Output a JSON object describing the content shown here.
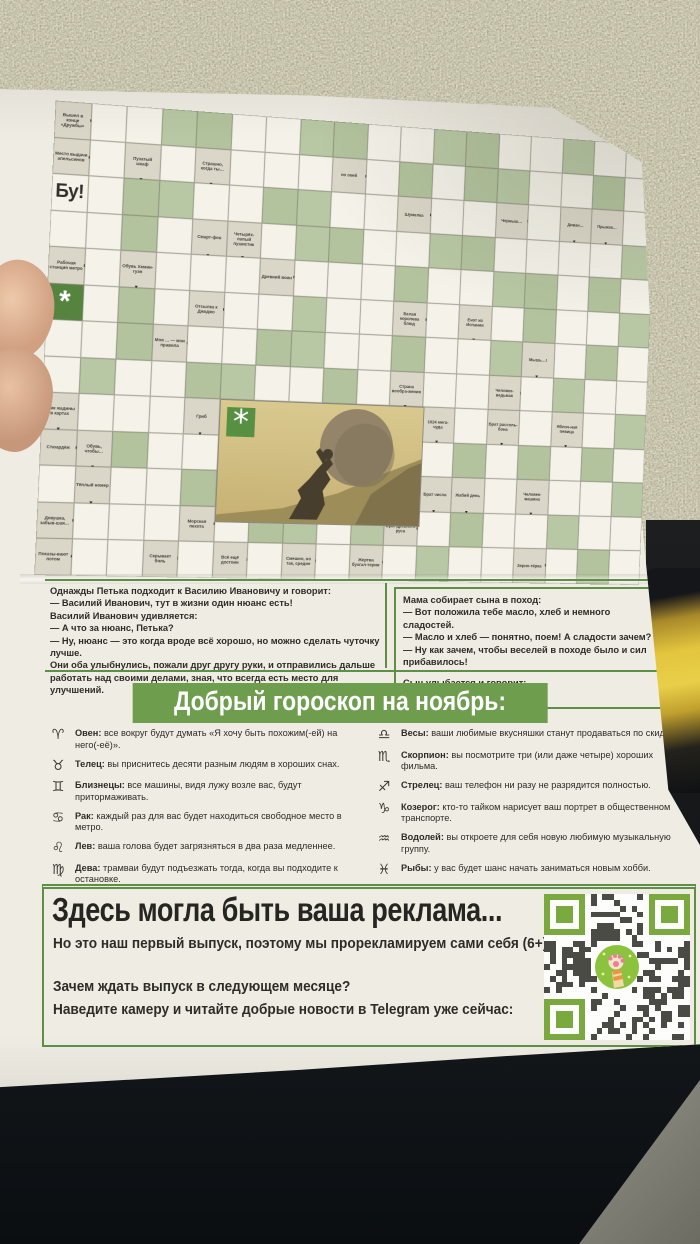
{
  "colors": {
    "accent_green": "#5d8f46",
    "heading_green": "#6f9d4e",
    "cell_green": "#b8c8a4",
    "clue_bg": "#dad7c8",
    "qr_green": "#79a93f",
    "paper": "#efece3"
  },
  "crossword": {
    "cols": 18,
    "bu": "Бу!",
    "asterisk": "*",
    "rows": [
      "cwwggwwggwwggwwgww",
      "cwcwcwwwcwgwggwwgw",
      "Bwggwwggwwcwwcwccw",
      "wwgwccwggwwggwwwwg",
      "cwcwwwcwwwgwwggwgw",
      "Awgwcwwgwwcwcwgwwg",
      "wwgcwwggwwgwwgcwgw",
      "wgwwggwwgwcwwcwgww",
      "cwwwciiiiiicwcwcwg",
      "ccgwwiiiiiiwgwgwgw",
      "wcwwgiiiiiiccwcwwg",
      "cwwwcwggwgcwgwwgww",
      "cwwcwcwcwcwgwwcwgw"
    ],
    "clues": [
      {
        "r": 0,
        "c": 0,
        "t": "Вышел в конце «Дружбы»",
        "a": "r"
      },
      {
        "r": 1,
        "c": 0,
        "t": "Место выдачи апельсинов",
        "a": "r"
      },
      {
        "r": 1,
        "c": 2,
        "t": "Пузатый шкаф",
        "a": "d"
      },
      {
        "r": 1,
        "c": 4,
        "t": "Страшно, когда ты…",
        "a": "d"
      },
      {
        "r": 1,
        "c": 8,
        "t": "но окей",
        "a": "r"
      },
      {
        "r": 2,
        "c": 10,
        "t": "Шумелка",
        "a": "r"
      },
      {
        "r": 2,
        "c": 13,
        "t": "Черныш…",
        "a": "r"
      },
      {
        "r": 2,
        "c": 15,
        "t": "Диван…",
        "a": "d"
      },
      {
        "r": 2,
        "c": 16,
        "t": "Прыжок…",
        "a": "d"
      },
      {
        "r": 3,
        "c": 4,
        "t": "Смарт-фон",
        "a": "d"
      },
      {
        "r": 3,
        "c": 5,
        "t": "Четырёх-лапый пушистик",
        "a": "d"
      },
      {
        "r": 4,
        "c": 0,
        "t": "Рабочая станция метро",
        "a": "r"
      },
      {
        "r": 4,
        "c": 2,
        "t": "Обувь Хемин-гуэя",
        "a": "d"
      },
      {
        "r": 4,
        "c": 6,
        "t": "Древний воин",
        "a": "r"
      },
      {
        "r": 5,
        "c": 4,
        "t": "Отсылка к Джоджо",
        "a": "r"
      },
      {
        "r": 5,
        "c": 10,
        "t": "Белая королева блюд",
        "a": "r"
      },
      {
        "r": 5,
        "c": 12,
        "t": "Енот из Испании",
        "a": "d"
      },
      {
        "r": 6,
        "c": 3,
        "t": "Моя … — мои правила",
        "a": "r"
      },
      {
        "r": 6,
        "c": 14,
        "t": "Мышь…!",
        "a": "d"
      },
      {
        "r": 7,
        "c": 10,
        "t": "Страна вообра-жения",
        "a": "d"
      },
      {
        "r": 7,
        "c": 13,
        "t": "Человек-ведьмак",
        "a": "r"
      },
      {
        "r": 8,
        "c": 0,
        "t": "Крик жадины в картах",
        "a": "d"
      },
      {
        "r": 8,
        "c": 4,
        "t": "Гриб",
        "a": "d"
      },
      {
        "r": 8,
        "c": 11,
        "t": "1024 мега-чуда",
        "a": "d"
      },
      {
        "r": 8,
        "c": 13,
        "t": "Брат рассоль-бона",
        "a": "d"
      },
      {
        "r": 8,
        "c": 15,
        "t": "Яблоч-ная певица",
        "a": "d"
      },
      {
        "r": 9,
        "c": 0,
        "t": "Стюардёж",
        "a": "r"
      },
      {
        "r": 9,
        "c": 1,
        "t": "Обувь, чтобы…",
        "a": "d"
      },
      {
        "r": 10,
        "c": 1,
        "t": "Тёплый номер",
        "a": "d"
      },
      {
        "r": 10,
        "c": 11,
        "t": "Брат числа",
        "a": "d"
      },
      {
        "r": 10,
        "c": 12,
        "t": "Жабий день",
        "a": "d"
      },
      {
        "r": 10,
        "c": 14,
        "t": "Человек-машина",
        "a": "d"
      },
      {
        "r": 11,
        "c": 0,
        "t": "Девушка, забыв-шая…",
        "a": "r"
      },
      {
        "r": 11,
        "c": 4,
        "t": "Морская пехота",
        "a": "r"
      },
      {
        "r": 11,
        "c": 10,
        "t": "Враг древнего руса",
        "a": "r"
      },
      {
        "r": 12,
        "c": 0,
        "t": "Показы-вают потом",
        "a": "r"
      },
      {
        "r": 12,
        "c": 3,
        "t": "Скрывает боль",
        "a": "r"
      },
      {
        "r": 12,
        "c": 5,
        "t": "Всё ещё достоин",
        "a": "r"
      },
      {
        "r": 12,
        "c": 7,
        "t": "Смешно, но так, средне",
        "a": "r"
      },
      {
        "r": 12,
        "c": 9,
        "t": "Жертва бухгал-терии",
        "a": "r"
      },
      {
        "r": 12,
        "c": 14,
        "t": "Зерно-тёрка",
        "a": "r"
      }
    ]
  },
  "jokes": {
    "left": [
      "Однажды Петька подходит к Василию Ивановичу и говорит:",
      "— Василий Иванович, тут в жизни один нюанс есть!",
      "Василий Иванович удивляется:",
      "— А что за нюанс, Петька?",
      "— Ну, нюанс — это когда вроде всё хорошо, но можно сделать чуточку лучше.",
      "Они оба улыбнулись, пожали друг другу руки, и отправились дальше работать над своими делами, зная, что всегда есть место для улучшений."
    ],
    "right": [
      "Мама собирает сына в поход:",
      "— Вот положила тебе масло, хлеб и немного сладостей.",
      "— Масло и хлеб — понятно, поем! А сладости зачем?",
      "— Ну как зачем, чтобы веселей в походе было и сил прибавилось!",
      "",
      "Сын улыбается и говорит:",
      "— Спасибо, мам!"
    ]
  },
  "horoscope": {
    "title": "Добрый гороскоп на ноябрь:",
    "left": [
      {
        "symbol": "♈",
        "sign": "Овен:",
        "text": "все вокруг будут думать «Я хочу быть похожим(-ей) на него(-её)»."
      },
      {
        "symbol": "♉",
        "sign": "Телец:",
        "text": "вы приснитесь десяти разным людям в хороших снах."
      },
      {
        "symbol": "♊",
        "sign": "Близнецы:",
        "text": "все машины, видя лужу возле вас, будут притормаживать."
      },
      {
        "symbol": "♋",
        "sign": "Рак:",
        "text": "каждый раз для вас будет находиться свободное место в метро."
      },
      {
        "symbol": "♌",
        "sign": "Лев:",
        "text": "ваша голова будет загрязняться в два раза медленнее."
      },
      {
        "symbol": "♍",
        "sign": "Дева:",
        "text": "трамваи будут подъезжать тогда, когда вы подходите к остановке."
      }
    ],
    "right": [
      {
        "symbol": "♎",
        "sign": "Весы:",
        "text": "ваши любимые вкусняшки станут продаваться по скидке."
      },
      {
        "symbol": "♏",
        "sign": "Скорпион:",
        "text": "вы посмотрите три (или даже четыре) хороших фильма."
      },
      {
        "symbol": "♐",
        "sign": "Стрелец:",
        "text": "ваш телефон ни разу не разрядится полностью."
      },
      {
        "symbol": "♑",
        "sign": "Козерог:",
        "text": "кто-то тайком нарисует ваш портрет в общественном транспорте."
      },
      {
        "symbol": "♒",
        "sign": "Водолей:",
        "text": "вы откроете для себя новую любимую музыкальную группу."
      },
      {
        "symbol": "♓",
        "sign": "Рыбы:",
        "text": "у вас будет шанс начать заниматься новым хобби."
      }
    ]
  },
  "ad": {
    "title": "Здесь могла быть ваша реклама...",
    "line1": "Но это наш первый выпуск, поэтому мы прорекламируем сами себя (6+):",
    "line2": "Зачем ждать выпуск в следующем месяце?",
    "line3": "Наведите камеру и читайте добрые новости в Telegram уже сейчас:"
  }
}
